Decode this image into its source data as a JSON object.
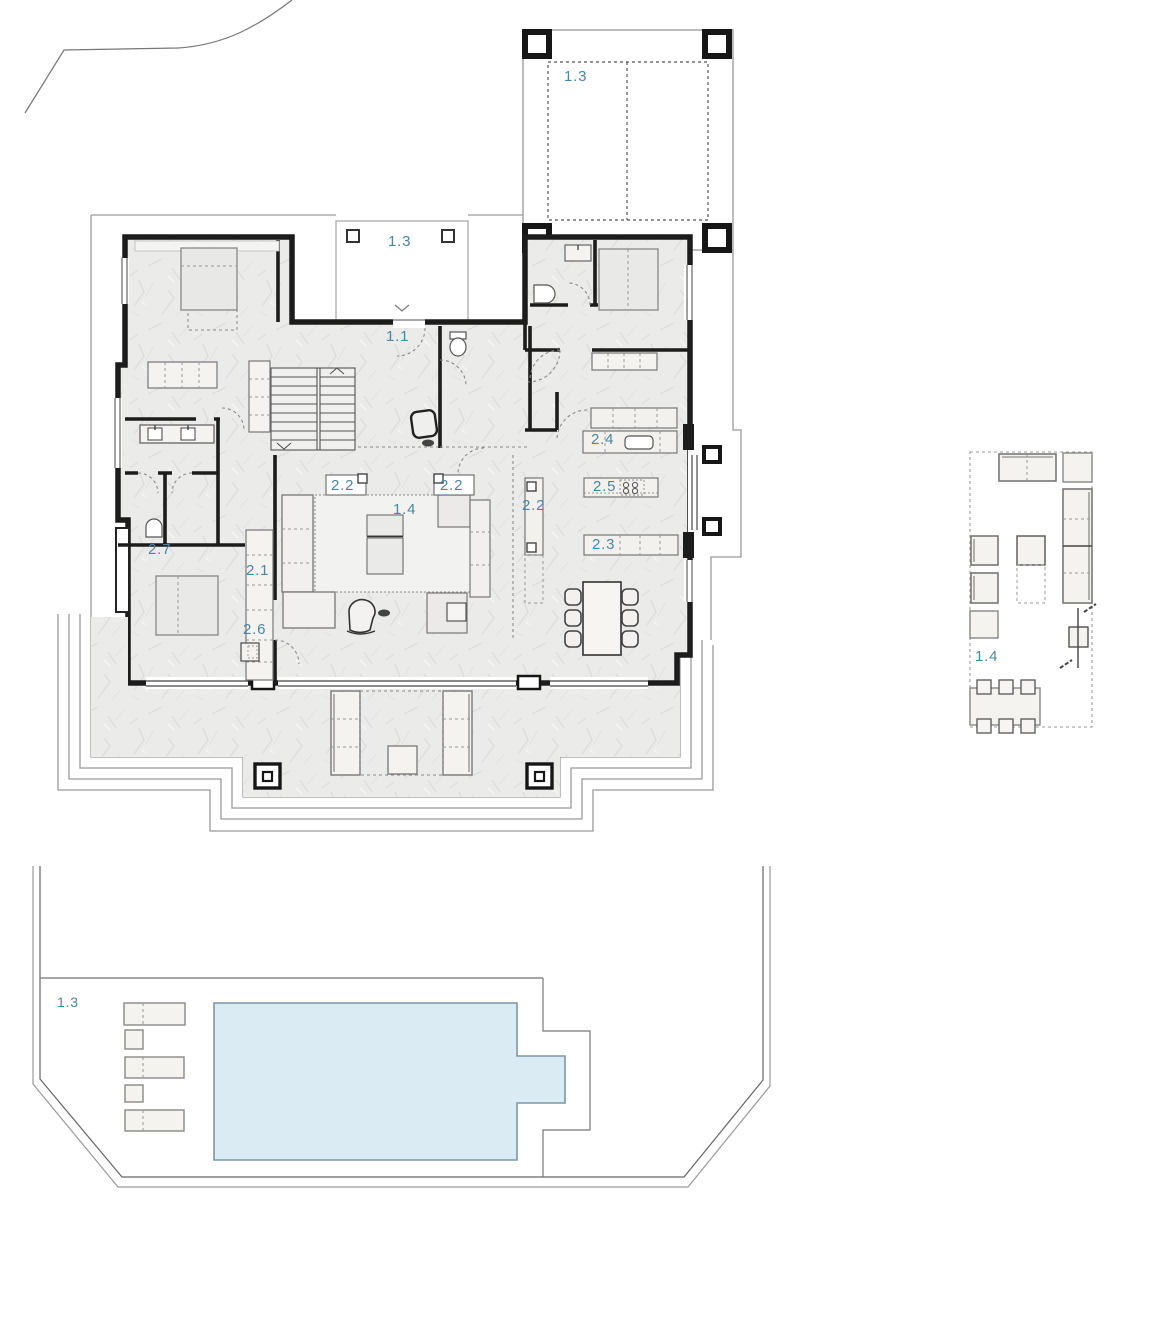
{
  "drawing": {
    "labels": {
      "upper_terrace": "1.3",
      "entry_porch": "1.3",
      "entry_hall": "1.1",
      "living_room": "1.4",
      "living_cabinet_left": "2.2",
      "living_cabinet_right": "2.2",
      "kitchen_tall_unit": "2.2",
      "kitchen_counter": "2.4",
      "kitchen_island": "2.5",
      "kitchen_low_counter": "2.3",
      "bedroom": "2.7",
      "wardrobe": "2.1",
      "side_unit": "2.6",
      "furniture_detail": "1.4",
      "pool_terrace": "1.3"
    },
    "colors": {
      "label": "#4a86a2",
      "pool": "#daebf4",
      "wall": "#1c1c1c",
      "floor": "#ebebe9",
      "site_line": "#9a9a9a"
    }
  }
}
